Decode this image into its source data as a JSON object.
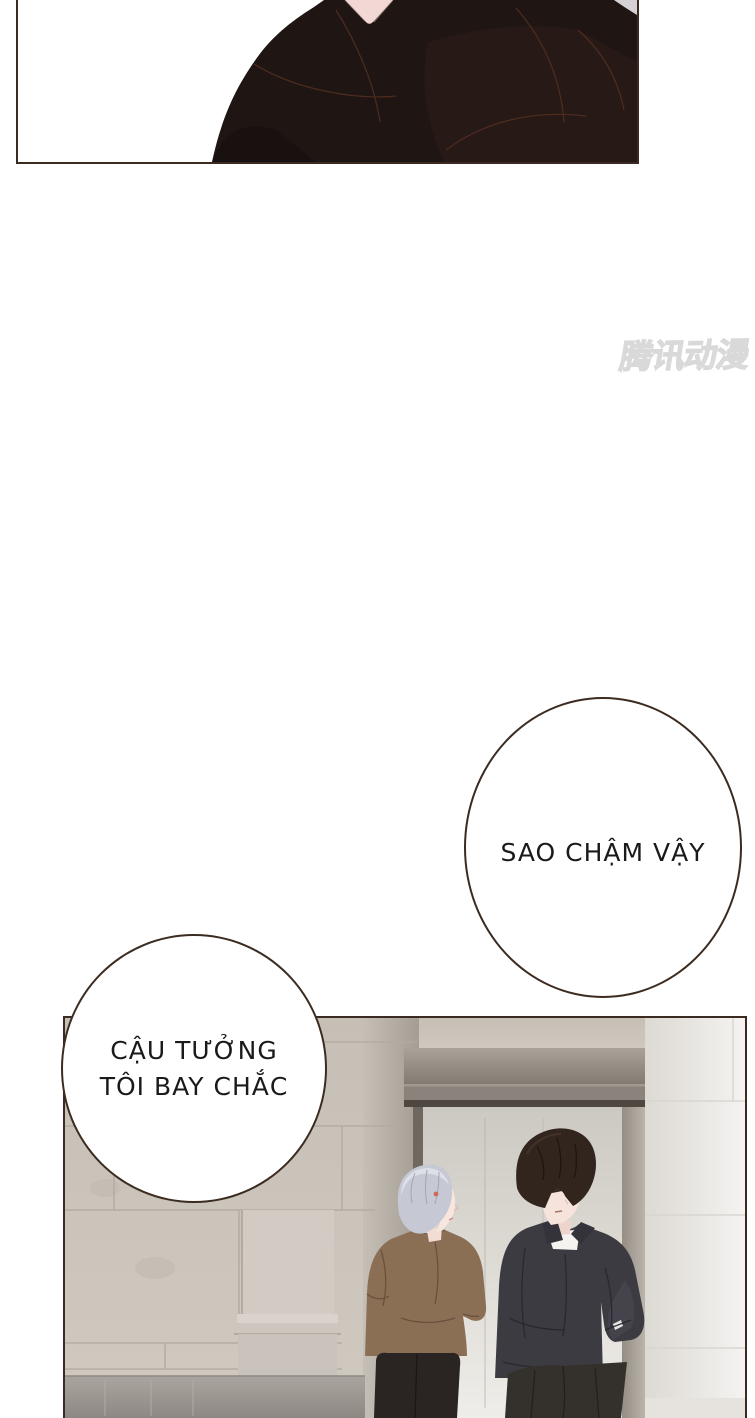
{
  "page_type": "comic-page",
  "watermark": {
    "text": "腾讯动漫"
  },
  "speech_bubbles": {
    "bubble1": {
      "text": "SAO CHẬM VẬY"
    },
    "bubble2": {
      "line1": "CẬU TƯỞNG",
      "line2": "TÔI BAY CHẮC"
    }
  },
  "panels": {
    "top": {
      "label": "close-up of dark jacketed shoulders and neck"
    },
    "bottom": {
      "label": "silver-haired man in brown shirt talking with black-haired man in dark shirt inside stone-tiled lobby with doorway"
    }
  },
  "colors": {
    "panel_border": "#3a2a21",
    "bubble_border": "#3c2b20",
    "text": "#1a1a1a",
    "figure_dark": "#1f1613",
    "neck_skin_pink": "#f2d8d5",
    "wall_tile": "#c8c2b9",
    "wall_joint": "#b1aaa1",
    "door_alcove": "#867e76",
    "door_lintel": "#8b837b",
    "door_interior": "#eeece8",
    "right_wall": "#f3f2f0",
    "floor": "#8e8984",
    "hair_silver": "#c6c8d3",
    "hair_black": "#31251e",
    "skin": "#f6e3db",
    "shirt_brown": "#8b6f54",
    "shirt_black": "#3d3b42",
    "pants_dark": "#2a2423",
    "watermark_gray": "#d9d9d9"
  }
}
